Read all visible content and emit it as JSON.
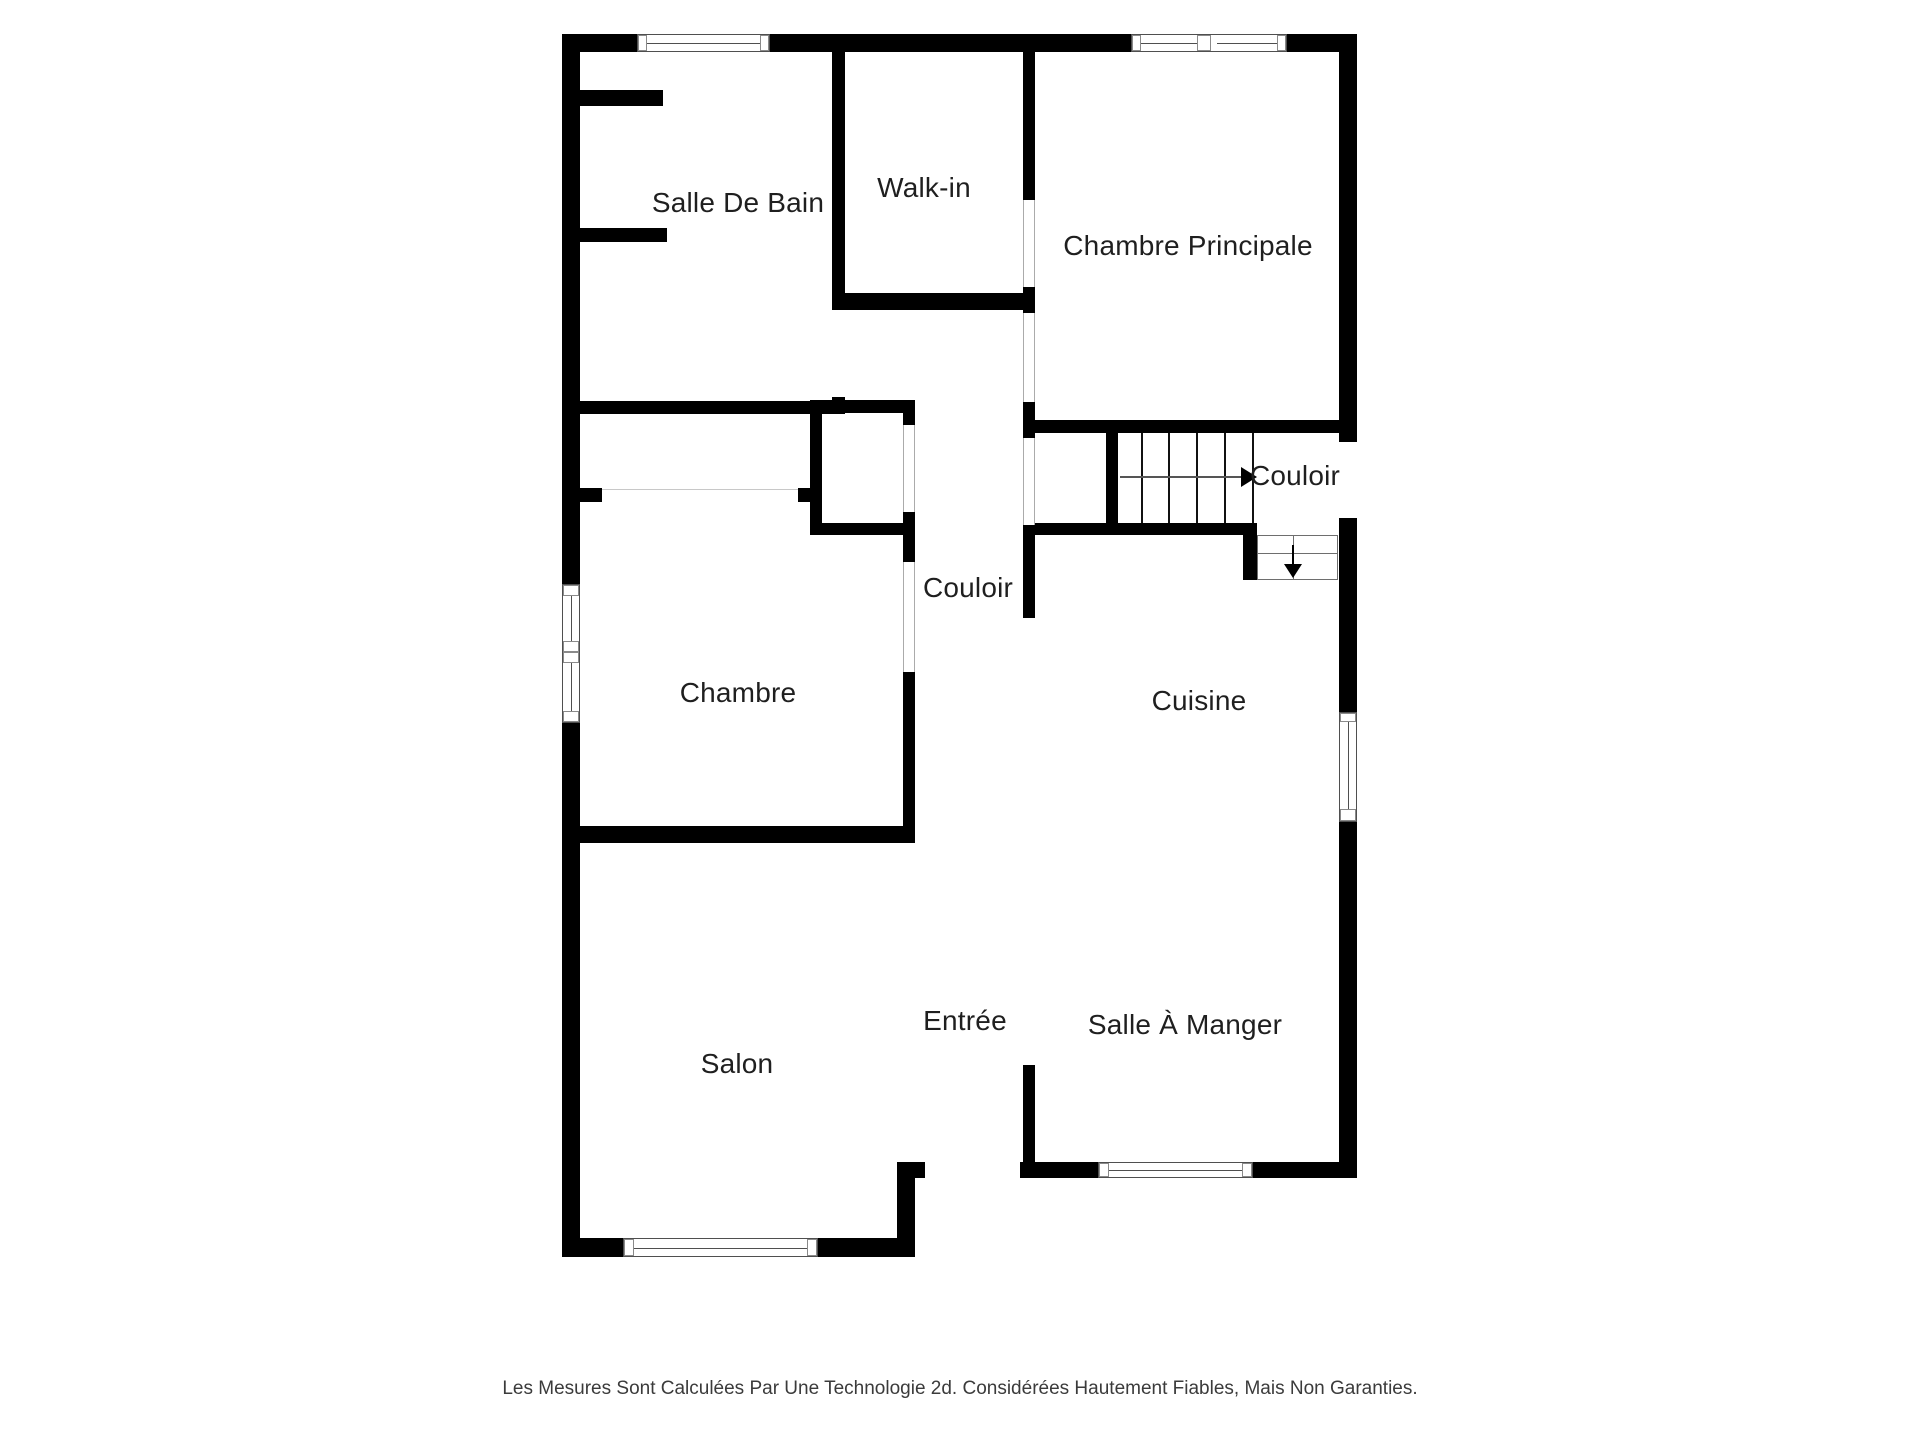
{
  "rooms": [
    {
      "id": "salle-de-bain",
      "label": "Salle De Bain"
    },
    {
      "id": "walk-in",
      "label": "Walk-in"
    },
    {
      "id": "chambre-principale",
      "label": "Chambre Principale"
    },
    {
      "id": "couloir-upper",
      "label": "Couloir"
    },
    {
      "id": "couloir-central",
      "label": "Couloir"
    },
    {
      "id": "chambre",
      "label": "Chambre"
    },
    {
      "id": "cuisine",
      "label": "Cuisine"
    },
    {
      "id": "entree",
      "label": "Entrée"
    },
    {
      "id": "salle-a-manger",
      "label": "Salle À Manger"
    },
    {
      "id": "salon",
      "label": "Salon"
    }
  ],
  "stairs": {
    "up_arrow_direction": "right",
    "down_arrow_direction": "down"
  },
  "footer": {
    "disclaimer": "Les Mesures Sont Calculées Par Une Technologie 2d. Considérées Hautement Fiables, Mais Non Garanties."
  },
  "colors": {
    "wall": "#000000",
    "background": "#ffffff",
    "label_text": "#1f1f1f",
    "footer_text": "#3b3b3b",
    "window_frame": "#4f4f4f",
    "door_jamb": "#ababab",
    "arrow": "#555555"
  }
}
